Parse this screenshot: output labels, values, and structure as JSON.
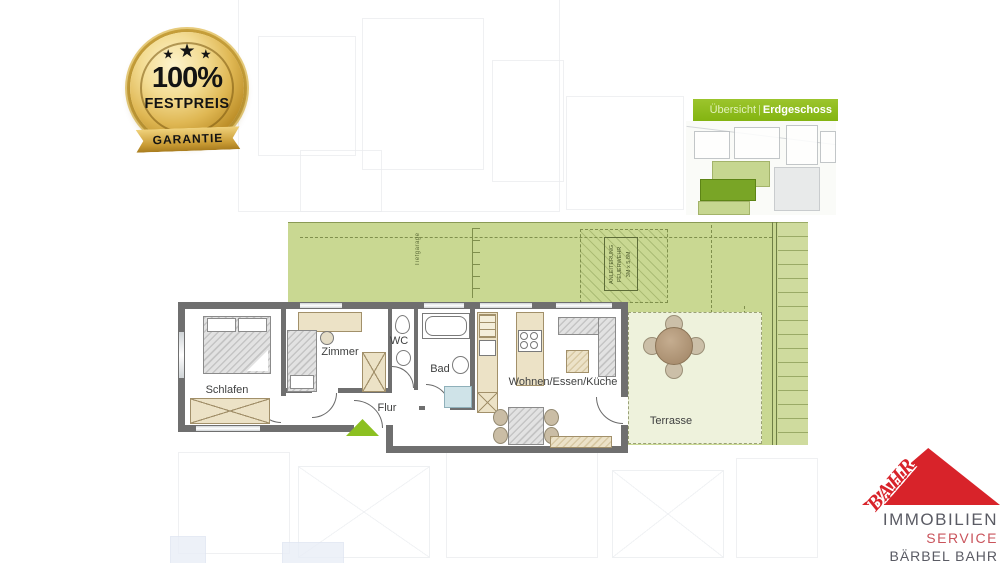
{
  "seal": {
    "star": "★",
    "percent": "100%",
    "festpreis": "FESTPREIS",
    "garantie": "GARANTIE"
  },
  "overview": {
    "uebersicht": "Übersicht",
    "separator": "|",
    "erdgeschoss": "Erdgeschoss"
  },
  "floorplan": {
    "labels": {
      "schlafen": "Schlafen",
      "zimmer": "Zimmer",
      "wc": "WC",
      "bad": "Bad",
      "flur": "Flur",
      "wohnen": "Wohnen/Essen/Küche",
      "terrasse": "Terrasse"
    },
    "annotations": {
      "fire_line1": "ANLEITERUNG",
      "fire_line2": "FEUERWEHR",
      "fire_line3": "3M x 5,8M",
      "garage": "Tiefgarage",
      "access": "Zugang Nr."
    }
  },
  "logo": {
    "brand": "BAHR",
    "immobilien": "IMMOBILIEN",
    "service": "SERVICE",
    "baerbel": "BÄRBEL BAHR"
  },
  "colors": {
    "accent_green": "#8abc1e",
    "garden_green": "#c9d892",
    "brand_red": "#d8232a",
    "wall_gray": "#6f6f6f",
    "seal_gold": "#dfb753"
  }
}
